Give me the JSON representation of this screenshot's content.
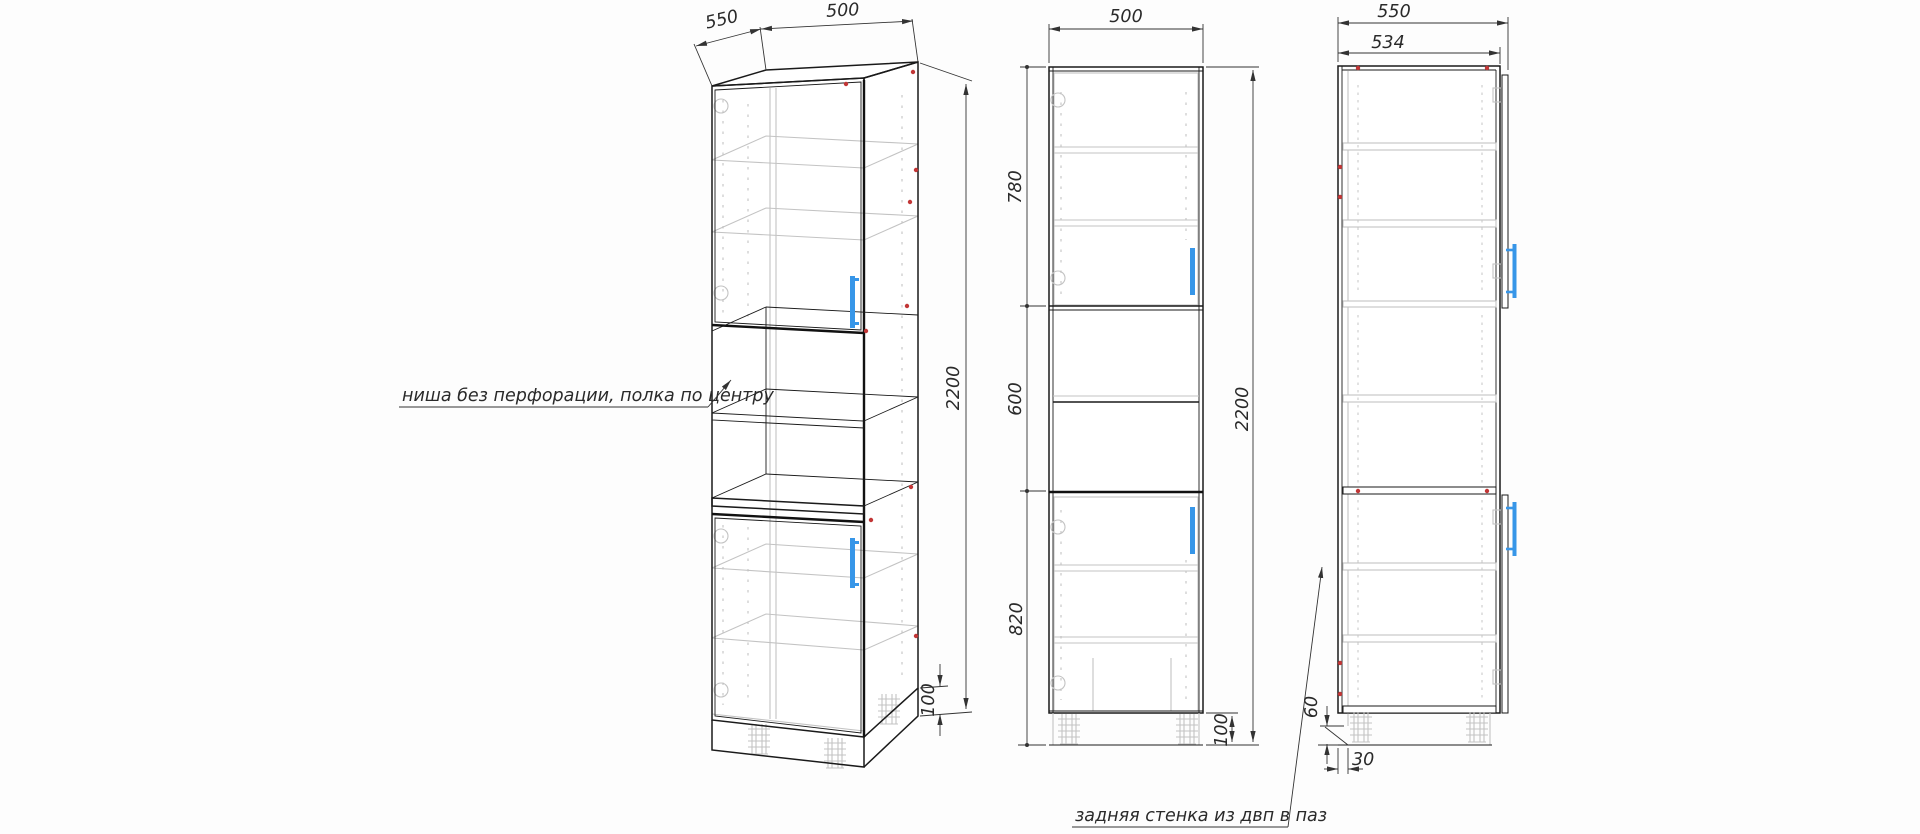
{
  "colors": {
    "outline": "#1a1a1a",
    "hidden_lines": "#c3c3c3",
    "dimension": "#333333",
    "handle_accent": "#3796e8",
    "assembly_marker": "#c23636"
  },
  "notes": {
    "niche": "ниша без перфорации, полка по центру",
    "back_panel": "задняя стенка из двп в паз"
  },
  "views": {
    "perspective": {
      "dims": {
        "depth": "550",
        "width": "500",
        "height": "2200",
        "plinth": "100"
      }
    },
    "front": {
      "dims": {
        "width": "500",
        "upper": "780",
        "niche": "600",
        "lower": "820",
        "height": "2200",
        "plinth": "100"
      }
    },
    "side": {
      "dims": {
        "overall_depth": "550",
        "carcass_depth": "534",
        "back_panel_bottom": "60",
        "groove_offset": "30"
      }
    }
  }
}
